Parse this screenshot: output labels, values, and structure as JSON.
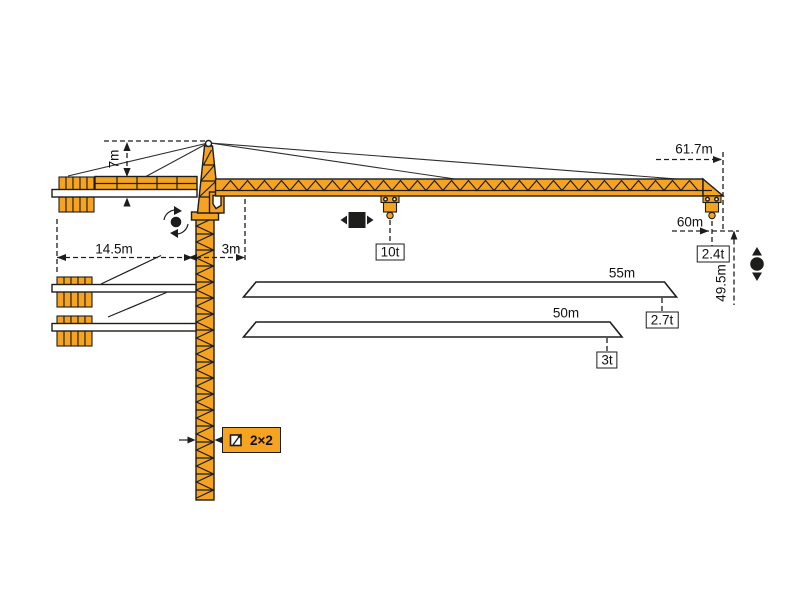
{
  "diagram": {
    "title": "tower-crane-working-range-diagram",
    "colors": {
      "crane": "#F6A321",
      "outline": "#1D1D1B",
      "background": "#FFFFFF"
    },
    "dimensions": {
      "tower_head_height": "7m",
      "counter_jib_radius": "14.5m",
      "min_radius": "3m",
      "jib_tip_radius": "61.7m",
      "max_hook_radius": "60m",
      "hook_height": "49.5m"
    },
    "capacities": {
      "max_load": "10t",
      "tip_load": "2.4t"
    },
    "jib_variants": [
      {
        "length": "55m",
        "tip_load": "2.7t"
      },
      {
        "length": "50m",
        "tip_load": "3t"
      }
    ],
    "tower": {
      "section_label": "2×2"
    },
    "symbols": [
      "slewing",
      "trolley-travel",
      "hoisting",
      "tower-section"
    ]
  }
}
